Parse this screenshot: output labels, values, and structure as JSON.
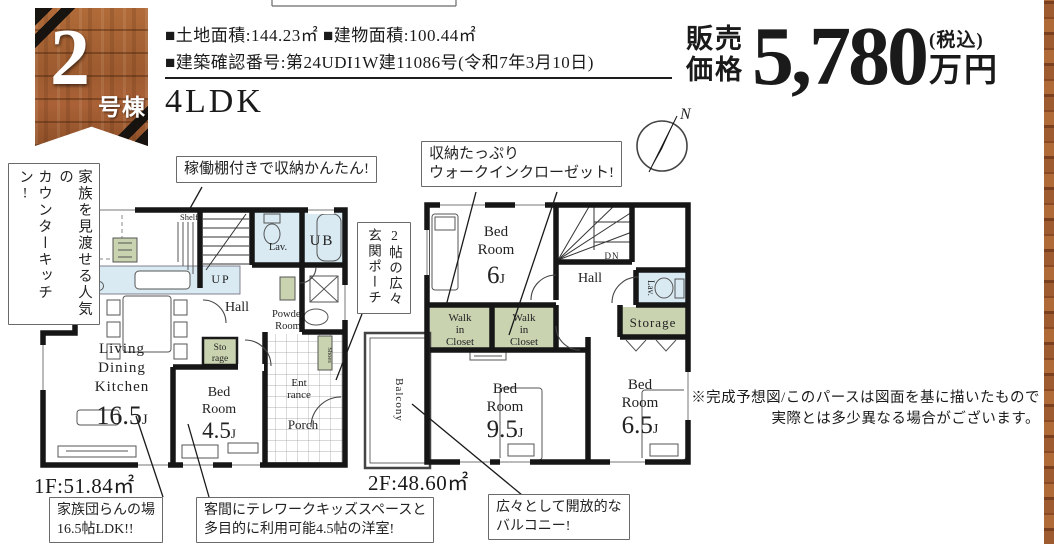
{
  "badge": {
    "number": "2",
    "suffix": "号棟"
  },
  "header": {
    "line1": "■土地面積:144.23㎡ ■建物面積:100.44㎡",
    "line2": "■建築確認番号:第24UDI1W建11086号(令和7年3月10日)",
    "layout": "4LDK"
  },
  "price": {
    "label_line1": "販売",
    "label_line2": "価格",
    "amount": "5,780",
    "tax_note": "(税込)",
    "unit": "万円"
  },
  "compass": {
    "north": "N"
  },
  "callouts": {
    "counter_kitchen_col1": "家族を見渡せる人気の",
    "counter_kitchen_col2": "カウンターキッチン!",
    "shelf": "稼働棚付きで収納かんたん!",
    "wic_line1": "収納たっぷり",
    "wic_line2": "ウォークインクローゼット!",
    "entrance_porch_col1": "2帖の広々",
    "entrance_porch_col2": "玄関ポーチ",
    "ldk_line1": "家族団らんの場",
    "ldk_line2": "16.5帖LDK!!",
    "guest_room_line1": "客間にテレワークキッズスペースと",
    "guest_room_line2": "多目的に利用可能4.5帖の洋室!",
    "balcony_line1": "広々として開放的な",
    "balcony_line2": "バルコニー!"
  },
  "floor1": {
    "area": "1F:51.84㎡",
    "rooms": {
      "fridge": "R",
      "shelf": "Shelf",
      "up": "UP",
      "lav": "Lav.",
      "bath": "UB",
      "powder_line1": "Powder",
      "powder_line2": "Room",
      "hall": "Hall",
      "storage_line1": "Sto",
      "storage_line2": "rage",
      "shoes": "Shoes",
      "ldk_line1": "Living",
      "ldk_line2": "Dining",
      "ldk_line3": "Kitchen",
      "ldk_size_num": "16.5",
      "ldk_size_unit": "J",
      "bedroom_line1": "Bed",
      "bedroom_line2": "Room",
      "bedroom_size_num": "4.5",
      "bedroom_size_unit": "J",
      "entrance_line1": "Ent",
      "entrance_line2": "rance",
      "porch": "Porch"
    }
  },
  "floor2": {
    "area": "2F:48.60㎡",
    "rooms": {
      "bedroom6_line1": "Bed",
      "bedroom6_line2": "Room",
      "bedroom6_size_num": "6",
      "bedroom6_size_unit": "J",
      "dn": "DN",
      "hall": "Hall",
      "lav": "Lav.",
      "wic1_line1": "Walk",
      "wic1_line2": "in",
      "wic1_line3": "Closet",
      "wic2_line1": "Walk",
      "wic2_line2": "in",
      "wic2_line3": "Closet",
      "storage": "Storage",
      "bedroom95_line1": "Bed",
      "bedroom95_line2": "Room",
      "bedroom95_size_num": "9.5",
      "bedroom95_size_unit": "J",
      "bedroom65_line1": "Bed",
      "bedroom65_line2": "Room",
      "bedroom65_size_num": "6.5",
      "bedroom65_size_unit": "J",
      "balcony": "Balcony"
    }
  },
  "disclaimer": {
    "line1": "※完成予想図/このパースは図面を基に描いたもので",
    "line2": "実際とは多少異なる場合がございます。"
  }
}
